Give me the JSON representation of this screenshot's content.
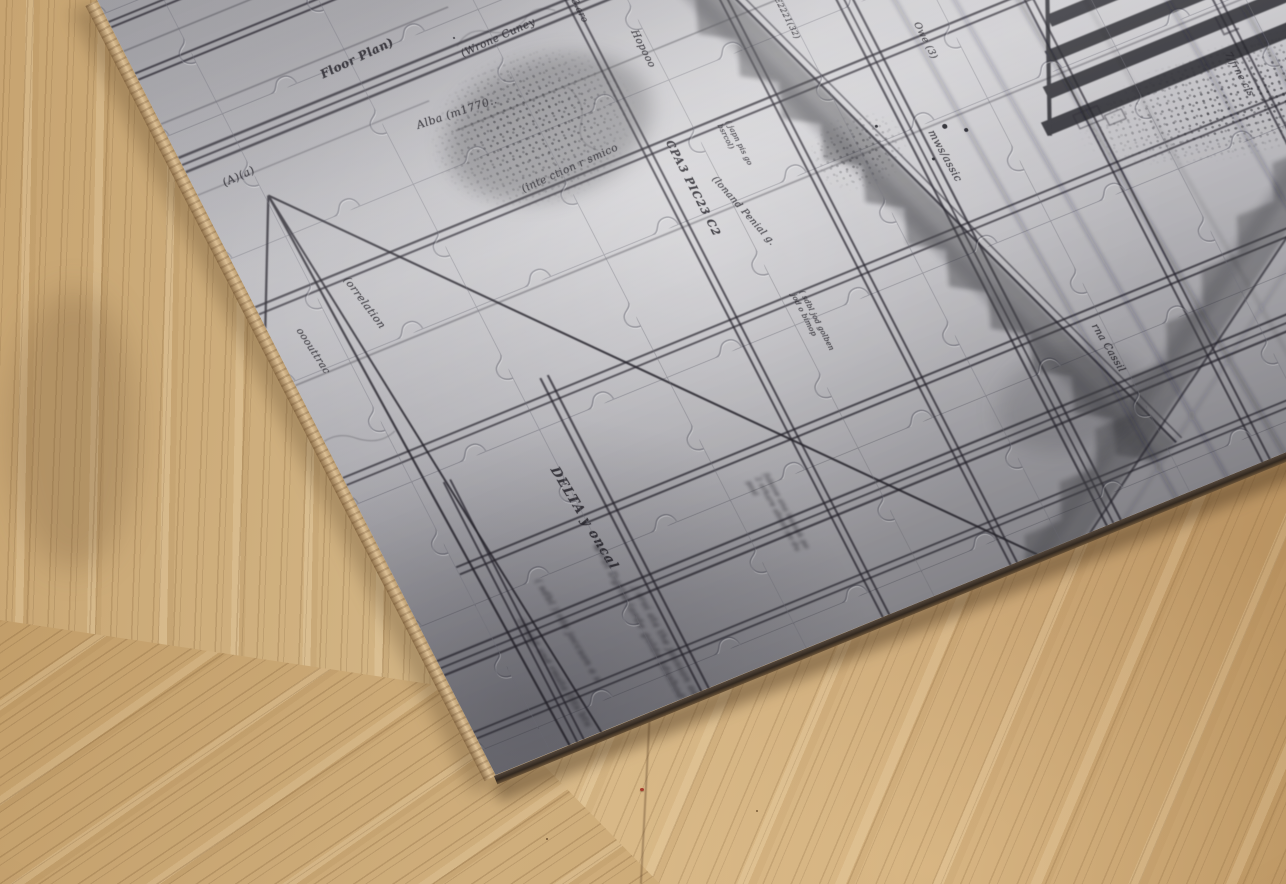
{
  "scene": {
    "description": "Photograph of a partially assembled grey jigsaw puzzle printed with an old hand-drawn survey map, lying tilted on a bamboo wood table",
    "surface": "bamboo wood table",
    "object": "jigsaw puzzle of a hand-drawn map"
  },
  "colors": {
    "wood_light": "#dcc49a",
    "wood_mid": "#c9a674",
    "wood_dark": "#9a7848",
    "paper": "#c3c2c7",
    "paper_shadow": "#97969c",
    "ink": "#2a2830",
    "cardboard_edge": "#4a3a2b",
    "cardboard_side": "#caa878",
    "speck_red": "#a63c2c"
  },
  "labels": {
    "aa": "(A)(a)",
    "floor_plan": "Floor Plan)",
    "wrone": "(Wrone Cuney",
    "alba": "Alba  (m1770..",
    "inte": "(inte ction r smico",
    "tisaro": "T13.aro",
    "hopoo": "Hopooo",
    "e2221": "E2221(32)",
    "owe": "Owe (3)",
    "cpa": "CPA3 PIC23 C2",
    "japn": "( japn pis go bsrcol)",
    "penial": "(lonand Penial g.",
    "sdbl": "( sdbl jod golben jod o bimop",
    "mws": "mws/assic",
    "rna": "rna Cassil",
    "jfrne": "7/frne cis",
    "delta": "DELTA y oncal",
    "oout": "ooouttrac",
    "corr": "(orrelation",
    "fabove": "fabove ana bssoak po 2 orkare abssd po du posl",
    "blur1": "w=bl Dgrlw (orde golde (dssbod lodk",
    "blur2": "( sdbl ) rde joccson a s",
    "blur3": "j sroi ata the jausson ad",
    "blur4": "(irsayt snd rmsta (lits btu"
  }
}
